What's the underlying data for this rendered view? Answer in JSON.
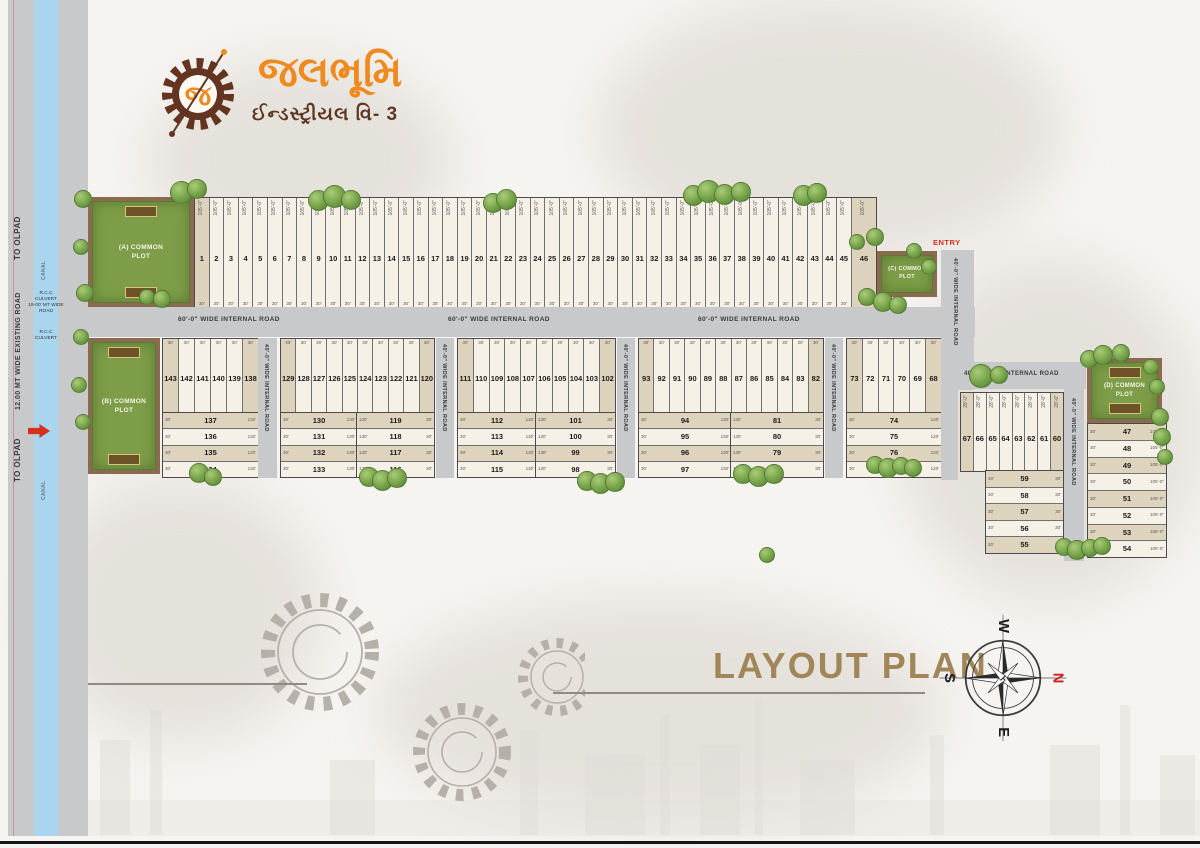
{
  "logo": {
    "title": "જલભૂમિ",
    "subtitle": "ઈન્ડસ્ટ્રીયલ વિ- 3",
    "monogram": "જ"
  },
  "title": "LAYOUT PLAN",
  "compass": {
    "n": "N",
    "e": "E",
    "s": "S",
    "w": "W"
  },
  "left_corridor": {
    "to_olpad_top": "TO OLPAD",
    "to_olpad_bottom": "TO OLPAD",
    "existing_road": "12.00 MT WIDE EXISTING ROAD",
    "canal_label_top": "CANAL",
    "canal_label_bottom": "CANAL",
    "culvert_top": "R.C.C CULVERT",
    "culvert_bottom": "R.C.C CULVERT",
    "wide_road": "18-00' MT WIDE ROAD",
    "entry": "ENTRY"
  },
  "roads": {
    "main_label": "60'-0\" WIDE INTERNAL ROAD",
    "cross_label": "40'-0\" WIDE INTERNAL ROAD",
    "entry_right": "ENTRY"
  },
  "common_plots": {
    "a": "(A) COMMON PLOT",
    "b": "(B) COMMON PLOT",
    "c": "(C) COMMON PLOT",
    "d": "(D) COMMON PLOT"
  },
  "dims": {
    "d105": "105'-0\"",
    "d30": "30'",
    "d28": "28'-0\"",
    "d130": "130'",
    "d120": "120'"
  },
  "plots": {
    "top_row": [
      1,
      2,
      3,
      4,
      5,
      6,
      7,
      8,
      9,
      10,
      11,
      12,
      13,
      14,
      15,
      16,
      17,
      18,
      19,
      20,
      21,
      22,
      23,
      24,
      25,
      26,
      27,
      28,
      29,
      30,
      31,
      32,
      33,
      34,
      35,
      36,
      37,
      38,
      39,
      40,
      41,
      42,
      43,
      44,
      45,
      46
    ],
    "block1_v": [
      143,
      142,
      141,
      140,
      139,
      138
    ],
    "block1_h": [
      137,
      136,
      135,
      134
    ],
    "block2_v": [
      129,
      128,
      127,
      126,
      125,
      124,
      123,
      122,
      121,
      120
    ],
    "block2_hl": [
      130,
      131,
      132,
      133
    ],
    "block2_hr": [
      119,
      118,
      117,
      116
    ],
    "block3_v": [
      111,
      110,
      109,
      108,
      107,
      106,
      105,
      104,
      103,
      102
    ],
    "block3_hl": [
      112,
      113,
      114,
      115
    ],
    "block3_hr": [
      101,
      100,
      99,
      98
    ],
    "block4_v": [
      93,
      92,
      91,
      90,
      89,
      88,
      87,
      86,
      85,
      84,
      83,
      82
    ],
    "block4_hl": [
      94,
      95,
      96,
      97
    ],
    "block4_hr": [
      81,
      80,
      79,
      78
    ],
    "block5_v": [
      73,
      72,
      71,
      70,
      69,
      68
    ],
    "block5_h": [
      74,
      75,
      76,
      77
    ],
    "block6_v": [
      67,
      66,
      65,
      64,
      63,
      62,
      61,
      60
    ],
    "block6_h": [
      59,
      58,
      57,
      56,
      55
    ],
    "right_col": [
      47,
      48,
      49,
      50,
      51,
      52,
      53,
      54
    ]
  }
}
